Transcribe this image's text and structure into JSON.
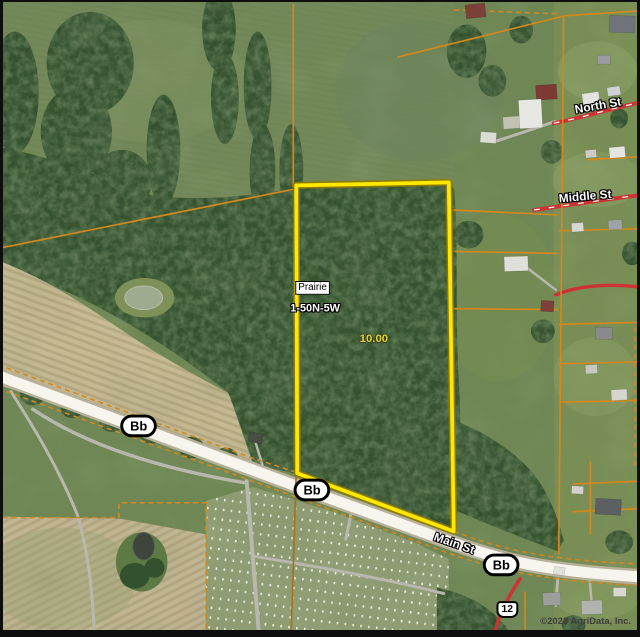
{
  "map": {
    "subject_parcel": {
      "name": "Prairie",
      "township": "1-50N-5W",
      "acres": "10.00"
    },
    "roads": {
      "north": "North St",
      "middle": "Middle St",
      "main": "Main St"
    },
    "route_badges": {
      "bb_west": "Bb",
      "bb_center": "Bb",
      "bb_east": "Bb",
      "route_12": "12"
    },
    "attribution": "©2023 AgriData, Inc.",
    "colors": {
      "parcel_highlight": "#ffe800",
      "parcel_casing": "#8f7a00",
      "boundary_orange": "#d4881c",
      "boundary_dark": "#a8721c",
      "road_red": "#cc3333",
      "road_fill": "#f7f5ee",
      "road_casing": "#b7b19a",
      "field_green": "#6f8755",
      "forest_green": "#33512e",
      "acres_text": "#d6d342",
      "badge_border": "#000000",
      "attribution_color": "#3f3e3a"
    }
  }
}
